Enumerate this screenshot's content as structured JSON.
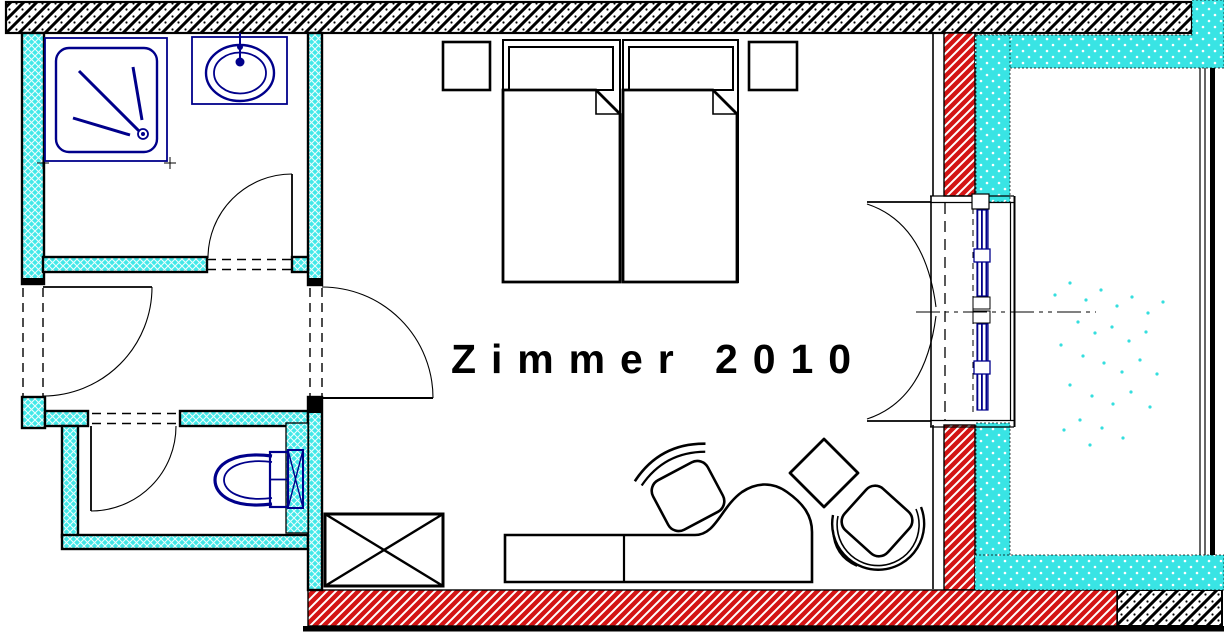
{
  "plan": {
    "room_label": "Zimmer 2010",
    "colors": {
      "line_black": "#000000",
      "sanitary_navy": "#00008b",
      "wall_red_hatch": "#d31414",
      "insulation_cyan": "#3fe6e6",
      "floor_white": "#ffffff"
    },
    "fixtures": {
      "shower": "shower-tray",
      "washbasin": "washbasin",
      "toilet": "wc-toilet",
      "bed_left": "bed",
      "bed_right": "bed",
      "nightstand_left": "nightstand",
      "nightstand_right": "nightstand",
      "wardrobe": "crossed-box-wardrobe",
      "desk": "desk-sideboard",
      "desk_chair": "desk-chair",
      "armchair": "armchair",
      "side_table": "diamond-side-table",
      "balcony_door": "double-balcony-door"
    }
  }
}
